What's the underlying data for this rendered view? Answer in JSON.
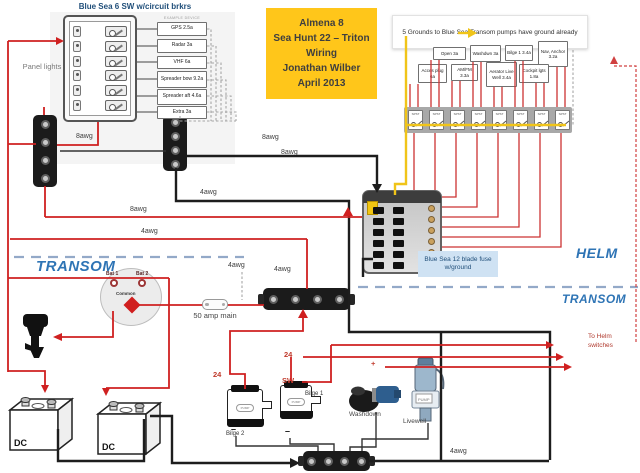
{
  "left_panel": {
    "title": "Blue Sea 6 SW w/circuit brkrs",
    "side_note": "Panel lights",
    "devices_header": "EXAMPLE DEVICE",
    "devices": [
      {
        "label": "GPS 2.5a",
        "x": 157,
        "y": 22,
        "w": 50,
        "h": 14
      },
      {
        "label": "Radar 3a",
        "x": 157,
        "y": 39,
        "w": 50,
        "h": 14
      },
      {
        "label": "VHF 6a",
        "x": 157,
        "y": 56,
        "w": 50,
        "h": 13
      },
      {
        "label": "Spreader bow 9.2a",
        "x": 157,
        "y": 71,
        "w": 50,
        "h": 17
      },
      {
        "label": "Spreader aft 4.6a",
        "x": 157,
        "y": 89,
        "w": 50,
        "h": 16
      },
      {
        "label": "Extra 3a",
        "x": 157,
        "y": 106,
        "w": 50,
        "h": 13
      }
    ]
  },
  "title_box": {
    "lines": [
      "Almena 8",
      "Sea Hunt 22 – Triton",
      "Wiring",
      "Jonathan Wilber",
      "April 2013"
    ]
  },
  "note": {
    "text": "5 Grounds to Blue Sea Transom pumps have ground already"
  },
  "helm": {
    "devices": [
      {
        "label": "Open 3a",
        "x": 433,
        "y": 47,
        "w": 33,
        "h": 13
      },
      {
        "label": "Washdwn 3a",
        "x": 470,
        "y": 45,
        "w": 31,
        "h": 17
      },
      {
        "label": "Bilge 1 3.4a",
        "x": 505,
        "y": 45,
        "w": 28,
        "h": 16
      },
      {
        "label": "Nav, Anchor 3.2a",
        "x": 538,
        "y": 41,
        "w": 30,
        "h": 26
      },
      {
        "label": "Acces plug 6a",
        "x": 418,
        "y": 64,
        "w": 29,
        "h": 19
      },
      {
        "label": "AM/FM 3.3a",
        "x": 451,
        "y": 64,
        "w": 27,
        "h": 17
      },
      {
        "label": "Aerator Live Well 3.4a",
        "x": 486,
        "y": 62,
        "w": 31,
        "h": 25
      },
      {
        "label": "Cockpit lgts 1.8a",
        "x": 519,
        "y": 64,
        "w": 30,
        "h": 19
      }
    ],
    "switch_type": "SPST",
    "switch_count": 8,
    "fuse_label": "Blue Sea 12 blade fuse w/ground",
    "zone_helm": "HELM",
    "zone_transom": "TRANSOM"
  },
  "transom": {
    "zone": "TRANSOM"
  },
  "battery_switch": {
    "bat1": "Bat 1",
    "bat2": "Bat 2",
    "common": "Common"
  },
  "components": {
    "fifty_amp": "50 amp main",
    "to_helm": "To Helm switches",
    "washdown": "Washdown",
    "livewell": "Livewell",
    "bilge1": "Bilge 1",
    "bilge2": "Bilge 2",
    "battery1_label": "DC",
    "battery2_label": "DC",
    "pump": "PUMP",
    "minus": "–"
  },
  "colors": {
    "wire_red": "#cf2020",
    "wire_black": "#1d1d1d",
    "wire_yellow": "#f0c419",
    "accent_blue": "#2e74b5",
    "title_bg": "#ffc61a",
    "fuse_label_bg": "#cfe2f3"
  },
  "wire_labels": [
    {
      "text": "8awg",
      "x": 76,
      "y": 133,
      "cls": "g"
    },
    {
      "text": "8awg",
      "x": 130,
      "y": 206,
      "cls": "g"
    },
    {
      "text": "4awg",
      "x": 141,
      "y": 228,
      "cls": "g"
    },
    {
      "text": "8awg",
      "x": 262,
      "y": 134,
      "cls": "g"
    },
    {
      "text": "8awg",
      "x": 281,
      "y": 149,
      "cls": "g"
    },
    {
      "text": "4awg",
      "x": 200,
      "y": 189,
      "cls": "g"
    },
    {
      "text": "4awg",
      "x": 228,
      "y": 262,
      "cls": "g"
    },
    {
      "text": "4awg",
      "x": 274,
      "y": 266,
      "cls": "g"
    },
    {
      "text": "4awg",
      "x": 450,
      "y": 448,
      "cls": "g"
    },
    {
      "text": "24",
      "x": 213,
      "y": 370,
      "cls": "r"
    },
    {
      "text": "24",
      "x": 284,
      "y": 350,
      "cls": "r"
    },
    {
      "text": "SW",
      "x": 282,
      "y": 376,
      "cls": "r"
    },
    {
      "text": "+",
      "x": 371,
      "y": 359,
      "cls": "r"
    }
  ]
}
